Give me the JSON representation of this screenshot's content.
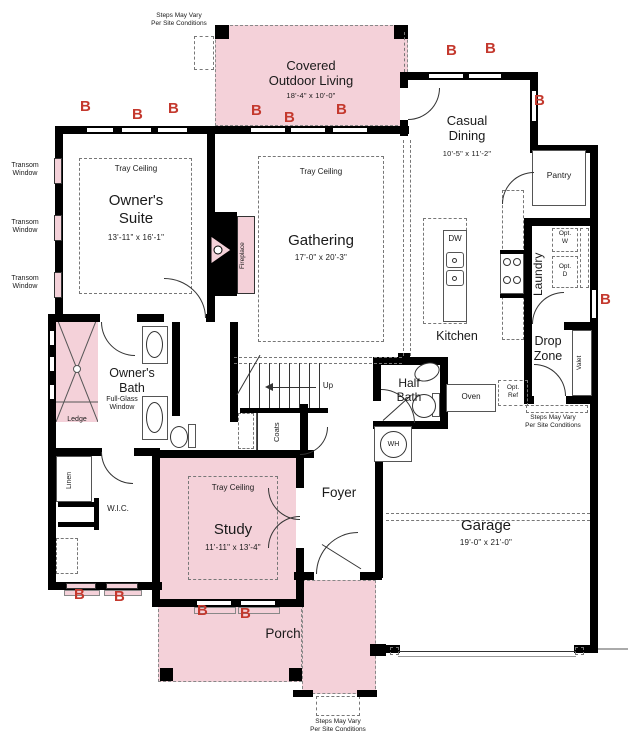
{
  "palette": {
    "pink": "#f4d1d9",
    "red": "#c4392e",
    "wall": "#000000"
  },
  "labels": {
    "tray_ceiling": "Tray Ceiling",
    "transom_window": "Transom\nWindow",
    "steps_note": "Steps May Vary\nPer Site Conditions",
    "b_marker": "B",
    "up": "Up",
    "dw": "DW",
    "oven": "Oven",
    "opt_ref": "Opt.\nRef",
    "opt_w": "Opt.\nW",
    "opt_d": "Opt.\nD",
    "wh": "WH",
    "valet": "Valet",
    "coats": "Coats",
    "linen": "Linen",
    "ledge": "Ledge",
    "fireplace": "Fireplace",
    "pantry": "Pantry",
    "kitchen": "Kitchen",
    "foyer": "Foyer",
    "porch": "Porch",
    "wic": "W.I.C.",
    "laundry": "Laundry",
    "full_glass_window": "Full-Glass\nWindow",
    "half_bath": "Half\nBath",
    "drop_zone": "Drop\nZone"
  },
  "rooms": {
    "covered_outdoor_living": {
      "name": "Covered\nOutdoor Living",
      "dims": "18'-4\" x 10'-0\""
    },
    "casual_dining": {
      "name": "Casual\nDining",
      "dims": "10'-5\" x 11'-2\""
    },
    "owners_suite": {
      "name": "Owner's\nSuite",
      "dims": "13'-11\" x 16'-1\""
    },
    "gathering": {
      "name": "Gathering",
      "dims": "17'-0\" x 20'-3\""
    },
    "study": {
      "name": "Study",
      "dims": "11'-11\" x 13'-4\""
    },
    "garage": {
      "name": "Garage",
      "dims": "19'-0\" x 21'-0\""
    },
    "owners_bath": {
      "name": "Owner's\nBath"
    }
  }
}
